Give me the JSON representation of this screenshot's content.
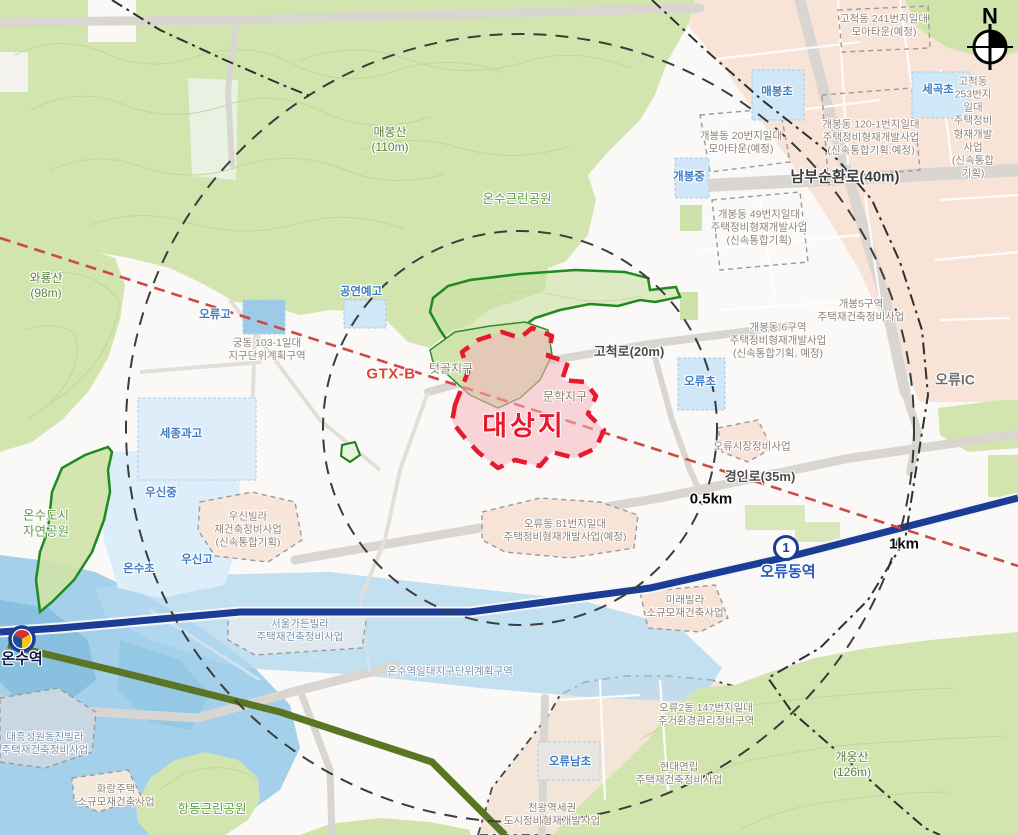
{
  "compass": {
    "north": "N"
  },
  "rings": [
    "0.5km",
    "1km"
  ],
  "site": {
    "label": "대상지"
  },
  "districts": [
    "텃골지구",
    "문학지구"
  ],
  "transit": {
    "gtx_label": "GTX-B",
    "line1_badge": "1",
    "stations": [
      "온수역",
      "오류동역"
    ],
    "interchange": "오류IC"
  },
  "roads": [
    "남부순환로(40m)",
    "고척로(20m)",
    "경인로(35m)"
  ],
  "mountains": [
    "매봉산\n(110m)",
    "와룡산\n(98m)",
    "개웅산\n(126m)"
  ],
  "parks": [
    "온수근린공원",
    "온수도시\n자연공원",
    "항동근린공원"
  ],
  "schools": [
    "매봉초",
    "세곡초",
    "개봉중",
    "공연예고",
    "오류고",
    "오류초",
    "세종과고",
    "우신중",
    "우신고",
    "온수초",
    "오류남초"
  ],
  "projects": [
    "고척동 241번지일대\n모아타운(예정)",
    "고척동 253번지일대\n주택정비형재개발사업\n(신속통합기획)",
    "개봉동 120-1번지일대\n주택정비형재개발사업\n(신속통합기획,예정)",
    "개봉동 20번지일대\n모아타운(예정)",
    "개봉동 49번지일대\n주택정비형재개발사업\n(신속통합기획)",
    "개봉5구역\n주택재건축정비사업",
    "개봉동 6구역\n주택정비형재개발사업\n(신속통합기획, 예정)",
    "궁동 103-1일대\n지구단위계획구역",
    "오류시장정비사업",
    "오류동 81번지일대\n주택정비형재개발사업(예정)",
    "우신빌라\n재건축정비사업\n(신속통합기획)",
    "서울가든빌라\n주택재건축정비사업",
    "온수역일대지구단위계획구역",
    "미래빌라\n소규모재건축사업",
    "대흥성원동진빌라\n주택재건축정비사업",
    "화랑주택\n소규모재건축사업",
    "오류2동 147번지일대\n주거환경관리정비구역",
    "현대연립\n주택재건축정비사업",
    "천왕역세권\n도시정비형재개발사업"
  ],
  "colors": {
    "site_red": "#e8192c",
    "gtx_red": "#dc4438",
    "line1_navy": "#1c3d96",
    "line7_olive": "#5a7523",
    "mountain_green": "#d3e5af",
    "zone_pink": "#f8e3d7",
    "zone_blue": "#a5d0ec"
  }
}
